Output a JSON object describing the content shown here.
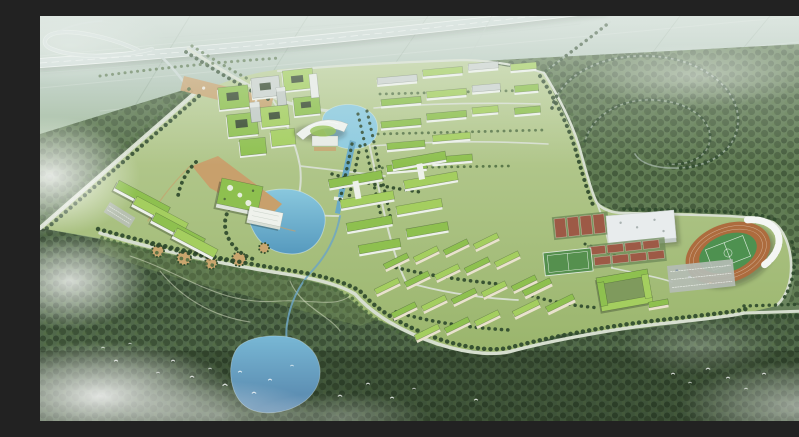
{
  "meta": {
    "type": "aerial architectural rendering",
    "description": "Bird's-eye master-plan rendering of an eco campus: green-roofed building clusters around a central lake, an arc-shaped hall on a canal, dormitory and residential rows, a gymnasium and oval stadium with orange running track, tree-lined boundary roads, an elevated expressway with loop interchange, hazy farmland beyond, dark forest and a second lake in the foreground, drifting fog and flocks of white birds",
    "width": 799,
    "height": 405
  },
  "scene": {
    "landmarks": [
      "elevated-expressway",
      "interchange-loop",
      "farmland-haze",
      "west-boulevard",
      "campus-grounds",
      "north-courtyard-cluster",
      "arc-hall",
      "north-pond",
      "canal",
      "ne-dormitory-rows",
      "academic-slab-pairs",
      "central-lake",
      "great-hall",
      "white-hall",
      "terraced-building",
      "entrance-plaza",
      "central-plaza",
      "garden-circles",
      "south-residential-grid",
      "east-dormitories",
      "courtyard-block",
      "gymnasium",
      "tennis-courts",
      "practice-field",
      "stadium",
      "running-track",
      "football-pitch",
      "grandstand",
      "parking-lot",
      "forest-east",
      "forest-south",
      "forest-west",
      "stream",
      "south-lake",
      "fog-patches",
      "bird-flocks"
    ]
  },
  "colors": {
    "road": "#d6decf",
    "roadfaint": "#b9c8c0",
    "treedark": "#2f4a2c",
    "treemid": "#4c6b40",
    "wall": "#edf1ea",
    "wallcream": "#e9e2cd",
    "roof": "#8ec04f",
    "roof2": "#a4ce5f",
    "roofgrey": "#ccd3cf",
    "court": "#9d5a46",
    "plaza": "#c8a06c",
    "bird": "#fdfefe",
    "lake": "#5ba3c4",
    "pond": "#5e93b8",
    "track": "#ad6c3e",
    "pitch": "#4e9150",
    "gym_roof": "#e8eced",
    "grandstand": "#f4f6f4",
    "parking": "#b4bcb4",
    "lawn_top": "#bccf9a",
    "lawn_bottom": "#9ab56c",
    "forest_mid": "#5f7b54",
    "forest_dark": "#50684a",
    "haze": "#c6d4cc"
  }
}
